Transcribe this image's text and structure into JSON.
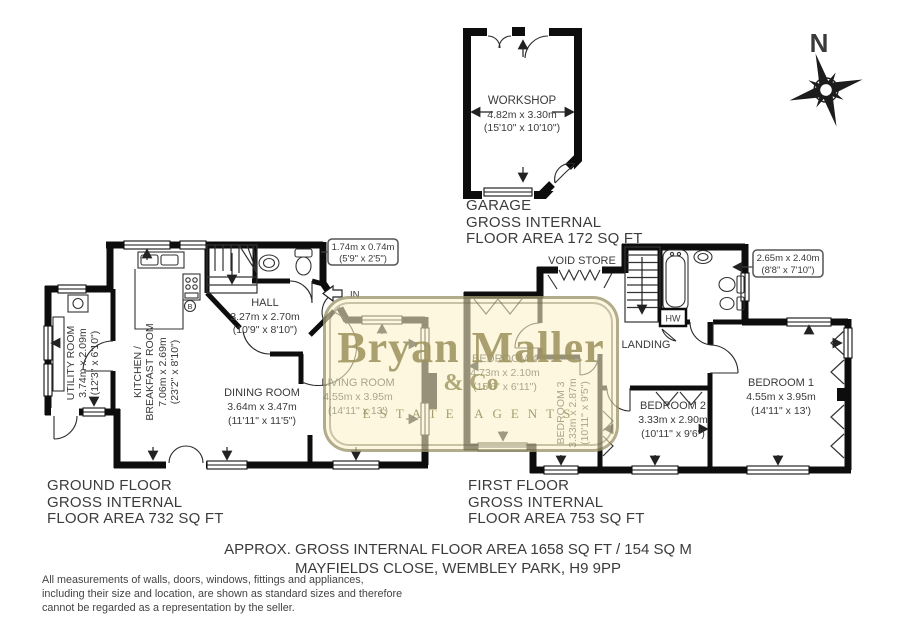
{
  "watermark": {
    "name": "Bryan Maller",
    "suffix": "& Co",
    "tagline": "ESTATE AGENTS"
  },
  "compass": {
    "north": "N"
  },
  "garage_plan": {
    "room": "WORKSHOP",
    "metric": "4.82m x 3.30m",
    "imperial": "(15'10\" x 10'10\")",
    "caption1": "GARAGE",
    "caption2": "GROSS INTERNAL",
    "caption3": "FLOOR AREA 172 SQ FT"
  },
  "ground_floor": {
    "caption1": "GROUND FLOOR",
    "caption2": "GROSS INTERNAL",
    "caption3": "FLOOR AREA 732 SQ FT",
    "hall": {
      "name": "HALL",
      "metric": "3.27m x 2.70m",
      "imperial": "(10'9\" x 8'10\")"
    },
    "dining": {
      "name": "DINING ROOM",
      "metric": "3.64m x 3.47m",
      "imperial": "(11'11\" x 11'5\")"
    },
    "living": {
      "name": "LIVING ROOM",
      "metric": "4.55m x 3.95m",
      "imperial": "(14'11\" x 13')"
    },
    "kitchen": {
      "name1": "KITCHEN /",
      "name2": "BREAKFAST ROOM",
      "metric": "7.06m x 2.69m",
      "imperial": "(23'2\" x 8'10\")"
    },
    "utility": {
      "name": "UTILITY ROOM",
      "metric": "3.74m x 2.09m",
      "imperial": "(12'3\" x 6'10\")"
    },
    "wc_dims": {
      "metric": "1.74m x 0.74m",
      "imperial": "(5'9\" x 2'5\")"
    },
    "entrance": "IN",
    "boiler": "B"
  },
  "first_floor": {
    "caption1": "FIRST FLOOR",
    "caption2": "GROSS INTERNAL",
    "caption3": "FLOOR AREA 753 SQ FT",
    "bedroom1": {
      "name": "BEDROOM 1",
      "metric": "4.55m x 3.95m",
      "imperial": "(14'11\" x 13')"
    },
    "bedroom2": {
      "name": "BEDROOM 2",
      "metric": "3.33m x 2.90m",
      "imperial": "(10'11\" x 9'6\")"
    },
    "bedroom3": {
      "name": "BEDROOM 3",
      "metric": "3.33m x 2.87m",
      "imperial": "(10'11\" x 9'5\")"
    },
    "bedroom4": {
      "name": "BEDROOM 4",
      "metric": "4.73m x 2.10m",
      "imperial": "(15'6\" x 6'11\")"
    },
    "landing": "LANDING",
    "void_store": "VOID STORE",
    "hot_water": "HW",
    "bath_dims": {
      "metric": "2.65m x 2.40m",
      "imperial": "(8'8\" x 7'10\")"
    }
  },
  "summary": {
    "line1": "APPROX. GROSS INTERNAL FLOOR AREA 1658 SQ FT / 154 SQ M",
    "line2": "MAYFIELDS CLOSE, WEMBLEY PARK, H9 9PP"
  },
  "disclaimer": {
    "line1": "All measurements of walls, doors, windows, fittings and appliances,",
    "line2": "including their size and location, are shown as standard sizes and therefore",
    "line3": "cannot be regarded as a representation by the seller."
  }
}
